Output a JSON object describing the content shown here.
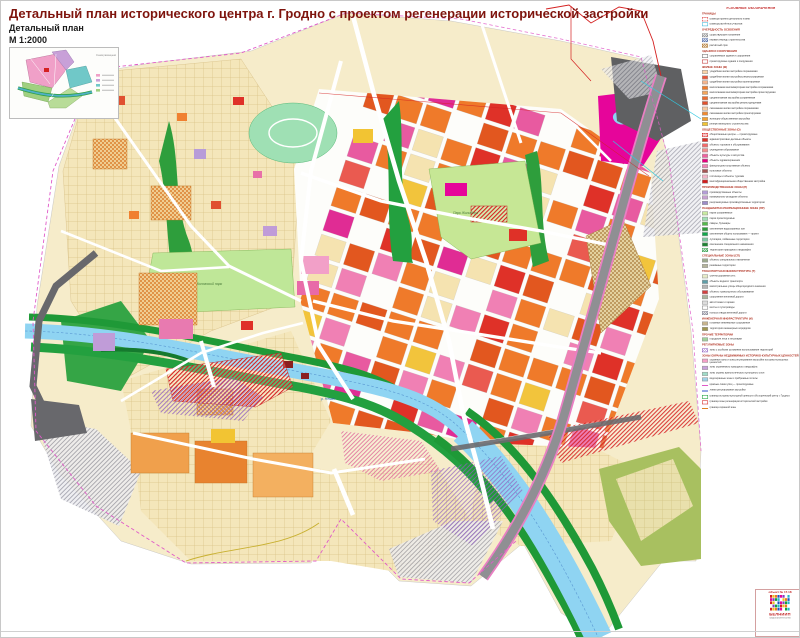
{
  "page": {
    "title": "Детальный план исторического центра г. Гродно с проектом регенерации исторической застройки",
    "subtitle": "Детальный план",
    "scale": "М   1:2000"
  },
  "inset": {
    "caption": "Схема размещения проектируемой территории в плане города"
  },
  "map_labels": [
    {
      "text": "Парк Жилибера",
      "x": 452,
      "y": 213,
      "color": "#4a7a3a"
    },
    {
      "text": "Коложский парк",
      "x": 196,
      "y": 284,
      "color": "#4a7a3a"
    },
    {
      "text": "р. Неман",
      "x": 320,
      "y": 399,
      "color": "#2a6aa8"
    }
  ],
  "legend": {
    "title": "УСЛОВНЫЕ ОБОЗНАЧЕНИЯ",
    "sections": [
      {
        "header": "ГРАНИЦЫ",
        "items": [
          {
            "swatch": {
              "t": "outline",
              "c": "#d83030",
              "dash": true
            },
            "label": "граница проекта детального плана"
          },
          {
            "swatch": {
              "t": "outline",
              "c": "#40b8d8"
            },
            "label": "граница расчётных участков"
          }
        ]
      },
      {
        "header": "ОЧЕРЕДНОСТЬ ОСВОЕНИЯ",
        "items": [
          {
            "swatch": {
              "t": "hatch",
              "c": "#909090"
            },
            "label": "существующее положение"
          },
          {
            "swatch": {
              "t": "hatch",
              "c": "#6078b0"
            },
            "label": "первая очередь строительства"
          },
          {
            "swatch": {
              "t": "hatch",
              "c": "#b07830"
            },
            "label": "расчётный срок"
          }
        ]
      },
      {
        "header": "ЗДАНИЯ И СООРУЖЕНИЯ",
        "items": [
          {
            "swatch": {
              "t": "outline",
              "c": "#707070"
            },
            "label": "сохраняемые здания и сооружения"
          },
          {
            "swatch": {
              "t": "outline",
              "c": "#c03030"
            },
            "label": "проектируемые здания и сооружения"
          }
        ]
      },
      {
        "header": "ЖИЛЫЕ ЗОНЫ (Ж)",
        "items": [
          {
            "swatch": {
              "t": "fill",
              "c": "#f9d3a8"
            },
            "label": "усадебная жилая застройка сохраняемая"
          },
          {
            "swatch": {
              "t": "fill",
              "c": "#e8553a"
            },
            "label": "усадебная жилая застройка реконструируемая"
          },
          {
            "swatch": {
              "t": "fill",
              "c": "#f5b48c"
            },
            "label": "усадебная жилая застройка проектируемая"
          },
          {
            "swatch": {
              "t": "fill",
              "c": "#f07a28"
            },
            "label": "малоэтажная многоквартирная застройка сохраняемая"
          },
          {
            "swatch": {
              "t": "fill",
              "c": "#f5a55a"
            },
            "label": "малоэтажная многоквартирная застройка проектируемая"
          },
          {
            "swatch": {
              "t": "fill",
              "c": "#ed6a2d"
            },
            "label": "среднеэтажная застройка сохраняемая"
          },
          {
            "swatch": {
              "t": "fill",
              "c": "#e2502d"
            },
            "label": "среднеэтажная застройка реконструируемая"
          },
          {
            "swatch": {
              "t": "fill",
              "c": "#f9c9a0"
            },
            "label": "смешанная жилая застройка сохраняемая"
          },
          {
            "swatch": {
              "t": "fill",
              "c": "#f08a30"
            },
            "label": "смешанная жилая застройка проектируемая"
          },
          {
            "swatch": {
              "t": "fill",
              "c": "#f5a030"
            },
            "label": "жилищно-общественная застройка"
          },
          {
            "swatch": {
              "t": "fill",
              "c": "#f2c433"
            },
            "label": "резерв жилищного строительства"
          }
        ]
      },
      {
        "header": "ОБЩЕСТВЕННЫЕ ЗОНЫ (О)",
        "items": [
          {
            "swatch": {
              "t": "hatch",
              "c": "#d62020"
            },
            "label": "общественные центры — проектируемые"
          },
          {
            "swatch": {
              "t": "fill",
              "c": "#e03028"
            },
            "label": "административно-деловые объекты"
          },
          {
            "swatch": {
              "t": "fill",
              "c": "#f26a6a"
            },
            "label": "объекты торговли и обслуживания"
          },
          {
            "swatch": {
              "t": "fill",
              "c": "#f58c8c"
            },
            "label": "учреждения образования"
          },
          {
            "swatch": {
              "t": "fill",
              "c": "#f2609e"
            },
            "label": "объекты культуры и искусства"
          },
          {
            "swatch": {
              "t": "fill",
              "c": "#e6007e"
            },
            "label": "объекты здравоохранения"
          },
          {
            "swatch": {
              "t": "fill",
              "c": "#f280b4"
            },
            "label": "физкультурно-спортивные объекты"
          },
          {
            "swatch": {
              "t": "fill",
              "c": "#a65454"
            },
            "label": "культовые объекты"
          },
          {
            "swatch": {
              "t": "fill",
              "c": "#f5b4c8"
            },
            "label": "гостиницы и объекты туризма"
          },
          {
            "swatch": {
              "t": "fill",
              "c": "#d21c1c"
            },
            "label": "многофункциональная общественная застройка"
          }
        ]
      },
      {
        "header": "ПРОИЗВОДСТВЕННЫЕ ЗОНЫ (П)",
        "items": [
          {
            "swatch": {
              "t": "fill",
              "c": "#b49cd8"
            },
            "label": "производственные объекты"
          },
          {
            "swatch": {
              "t": "fill",
              "c": "#c8a0d2"
            },
            "label": "коммунально-складские объекты"
          },
          {
            "swatch": {
              "t": "fill",
              "c": "#9c8cc8"
            },
            "label": "реорганизуемые производственные территории"
          }
        ]
      },
      {
        "header": "ЛАНДШАФТНО-РЕКРЕАЦИОННЫЕ ЗОНЫ (ЛР)",
        "items": [
          {
            "swatch": {
              "t": "fill",
              "c": "#c8eba0"
            },
            "label": "парки сохраняемые"
          },
          {
            "swatch": {
              "t": "fill",
              "c": "#9fe0b4"
            },
            "label": "парки проектируемые"
          },
          {
            "swatch": {
              "t": "fill",
              "c": "#55b94b"
            },
            "label": "скверы, бульвары"
          },
          {
            "swatch": {
              "t": "fill",
              "c": "#2e9e3c"
            },
            "label": "озеленение водоохранных зон"
          },
          {
            "swatch": {
              "t": "fill",
              "c": "#0fa84b"
            },
            "label": "озеленение общего пользования — проект"
          },
          {
            "swatch": {
              "t": "fill",
              "c": "#7ac8a0"
            },
            "label": "лугопарки, пойменные территории"
          },
          {
            "swatch": {
              "t": "fill",
              "c": "#1e8232"
            },
            "label": "озеленение специального назначения"
          },
          {
            "swatch": {
              "t": "hatch",
              "c": "#3aa050"
            },
            "label": "территории природного ландшафта"
          }
        ]
      },
      {
        "header": "СПЕЦИАЛЬНЫЕ ЗОНЫ (СП)",
        "items": [
          {
            "swatch": {
              "t": "fill",
              "c": "#9caa8c"
            },
            "label": "объекты специального назначения"
          },
          {
            "swatch": {
              "t": "fill",
              "c": "#b4b49c"
            },
            "label": "режимные территории"
          }
        ]
      },
      {
        "header": "ТРАНСПОРТНАЯ ИНФРАСТРУКТУРА (Т)",
        "items": [
          {
            "swatch": {
              "t": "fill",
              "c": "#e6ebc8"
            },
            "label": "улично-дорожная сеть"
          },
          {
            "swatch": {
              "t": "fill",
              "c": "#5e9ea8"
            },
            "label": "объекты водного транспорта"
          },
          {
            "swatch": {
              "t": "fill",
              "c": "#b4b4b4"
            },
            "label": "магистральные улицы общегородского значения"
          },
          {
            "swatch": {
              "t": "fill",
              "c": "#d24040"
            },
            "label": "объекты транспортного обслуживания"
          },
          {
            "swatch": {
              "t": "fill",
              "c": "#a8b49c"
            },
            "label": "сооружения железной дороги"
          },
          {
            "swatch": {
              "t": "fill",
              "c": "#dcdcdc"
            },
            "label": "автостоянки и гаражи"
          },
          {
            "swatch": {
              "t": "outline",
              "c": "#808080"
            },
            "label": "мосты и путепроводы"
          },
          {
            "swatch": {
              "t": "hatch",
              "c": "#888898"
            },
            "label": "полоса отвода железной дороги"
          }
        ]
      },
      {
        "header": "ИНЖЕНЕРНАЯ ИНФРАСТРУКТУРА (И)",
        "items": [
          {
            "swatch": {
              "t": "fill",
              "c": "#c8b48c"
            },
            "label": "головные инженерные сооружения"
          },
          {
            "swatch": {
              "t": "fill",
              "c": "#a09650"
            },
            "label": "территории инженерных коридоров"
          }
        ]
      },
      {
        "header": "ПРОЧИЕ ТЕРРИТОРИИ",
        "items": [
          {
            "swatch": {
              "t": "fill",
              "c": "#a0d29b"
            },
            "label": "городские леса и лесопарки"
          }
        ]
      },
      {
        "header": "РЕГУЛИРУЕМЫЕ ЗОНЫ",
        "items": [
          {
            "swatch": {
              "t": "hatch",
              "c": "#9060c0"
            },
            "label": "зоны с особыми условиями использования территорий"
          }
        ]
      }
    ],
    "notes_header": "ЗОНЫ ОХРАНЫ НЕДВИЖИМЫХ ИСТОРИКО-КУЛЬТУРНЫХ ЦЕННОСТЕЙ",
    "notes": [
      {
        "swatch": {
          "t": "fill",
          "c": "#f5a0c8"
        },
        "label": "охранные зоны и зоны регулирования застройки историко-культурных ценностей"
      },
      {
        "swatch": {
          "t": "fill",
          "c": "#c8a0dc"
        },
        "label": "зоны охраняемого природного ландшафта"
      },
      {
        "swatch": {
          "t": "fill",
          "c": "#a0dcc8"
        },
        "label": "зоны охраны археологического культурного слоя"
      },
      {
        "swatch": {
          "t": "fill",
          "c": "#a0d2e6"
        },
        "label": "водоохранные зоны и прибрежные полосы"
      },
      {
        "swatch": {
          "t": "line",
          "c": "#e05ac8"
        },
        "label": "красные линии улиц — проектируемые"
      },
      {
        "swatch": {
          "t": "line",
          "c": "#3050c8"
        },
        "label": "линии регулирования застройки"
      },
      {
        "swatch": {
          "t": "outline",
          "c": "#18a038"
        },
        "label": "граница историко-культурной ценности «Исторический центр г. Гродно»"
      },
      {
        "swatch": {
          "t": "outline",
          "c": "#d42020"
        },
        "label": "граница зоны регенерации исторической застройки"
      },
      {
        "swatch": {
          "t": "line",
          "c": "#e08020"
        },
        "label": "граница охранной зоны"
      }
    ]
  },
  "stamp": {
    "object": "объект № 17.18",
    "org": "БЕЛНИИП",
    "org_sub": "градостроительства"
  }
}
